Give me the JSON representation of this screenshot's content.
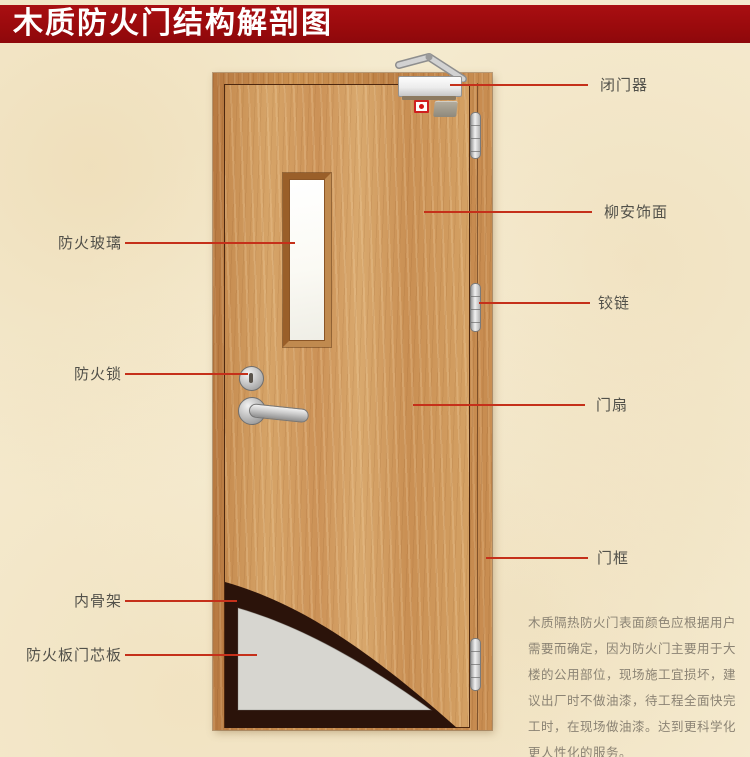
{
  "title": "木质防火门结构解剖图",
  "colors": {
    "banner_bg": "#9b0a0d",
    "banner_text": "#ffffff",
    "leader_line": "#c5301a",
    "label_text": "#52514a",
    "background": "#f5ebd0",
    "door_wood": "#d09a60",
    "frame_wood": "#c5854b",
    "core_board_gray": "#d7d6d0",
    "inner_skeleton_dark": "#2b130a",
    "glass_white": "#fbfaf4"
  },
  "callouts": {
    "left": [
      {
        "id": "fire-glass",
        "text": "防火玻璃"
      },
      {
        "id": "fire-lock",
        "text": "防火锁"
      },
      {
        "id": "inner-skeleton",
        "text": "内骨架"
      },
      {
        "id": "fire-core-board",
        "text": "防火板门芯板"
      }
    ],
    "right": [
      {
        "id": "door-closer",
        "text": "闭门器"
      },
      {
        "id": "lauan-veneer",
        "text": "柳安饰面"
      },
      {
        "id": "hinge",
        "text": "铰链"
      },
      {
        "id": "door-leaf",
        "text": "门扇"
      },
      {
        "id": "door-frame",
        "text": "门框"
      }
    ]
  },
  "description": "木质隔热防火门表面颜色应根据用户需要而确定，因为防火门主要用于大楼的公用部位，现场施工宜损坏，建议出厂时不做油漆，待工程全面快完工时，在现场做油漆。达到更科学化更人性化的服务。"
}
